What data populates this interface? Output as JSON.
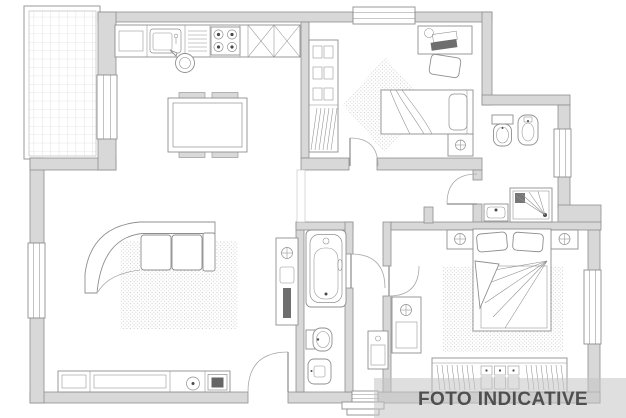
{
  "watermark": {
    "text": "FOTO INDICATIVE",
    "band_color": "#c4c4c4",
    "band_opacity": "0.55",
    "text_color": "#4f4f4f"
  },
  "palette": {
    "background": "#ffffff",
    "wall_fill": "#d8d8d8",
    "wall_stroke": "#8f8f8f",
    "furniture_stroke": "#8f8f8f",
    "detail_dark": "#4a4a4a",
    "rug_dot": "#c6c6c6",
    "tile_line": "#cfcfcf"
  },
  "plan": {
    "type": "apartment-floor-plan",
    "windows": 5,
    "door_arcs": 5,
    "rooms": [
      {
        "name": "balcony",
        "icons": [
          "floor-tile-grid"
        ]
      },
      {
        "name": "kitchen-living-room",
        "icons": [
          "kitchen-counter",
          "sink",
          "dish-rack",
          "hob-4-burners",
          "corner-cabinet-x",
          "kettle",
          "dining-table",
          "dining-chairs",
          "curved-sofa",
          "rug",
          "sideboard",
          "speaker",
          "tv",
          "utility-column",
          "radiator-valve"
        ]
      },
      {
        "name": "small-bedroom",
        "icons": [
          "wardrobe-shelves",
          "desk",
          "desk-chair",
          "desk-lamp",
          "laptop",
          "single-bed",
          "pillow",
          "nightstand",
          "table-lamp",
          "diamond-rug",
          "window"
        ]
      },
      {
        "name": "ensuite-bathroom",
        "icons": [
          "toilet",
          "bidet",
          "shower",
          "washbasin",
          "window"
        ]
      },
      {
        "name": "main-bathroom",
        "icons": [
          "bathtub",
          "toilet",
          "bidet"
        ]
      },
      {
        "name": "entrance-corridor",
        "icons": [
          "cabinet",
          "entry-steps",
          "threshold"
        ]
      },
      {
        "name": "master-bedroom",
        "icons": [
          "double-bed",
          "pillows",
          "nightstand-left",
          "nightstand-right",
          "table-lamps",
          "rug",
          "wardrobe-with-drawers",
          "radiator-cabinet",
          "window"
        ]
      }
    ]
  }
}
